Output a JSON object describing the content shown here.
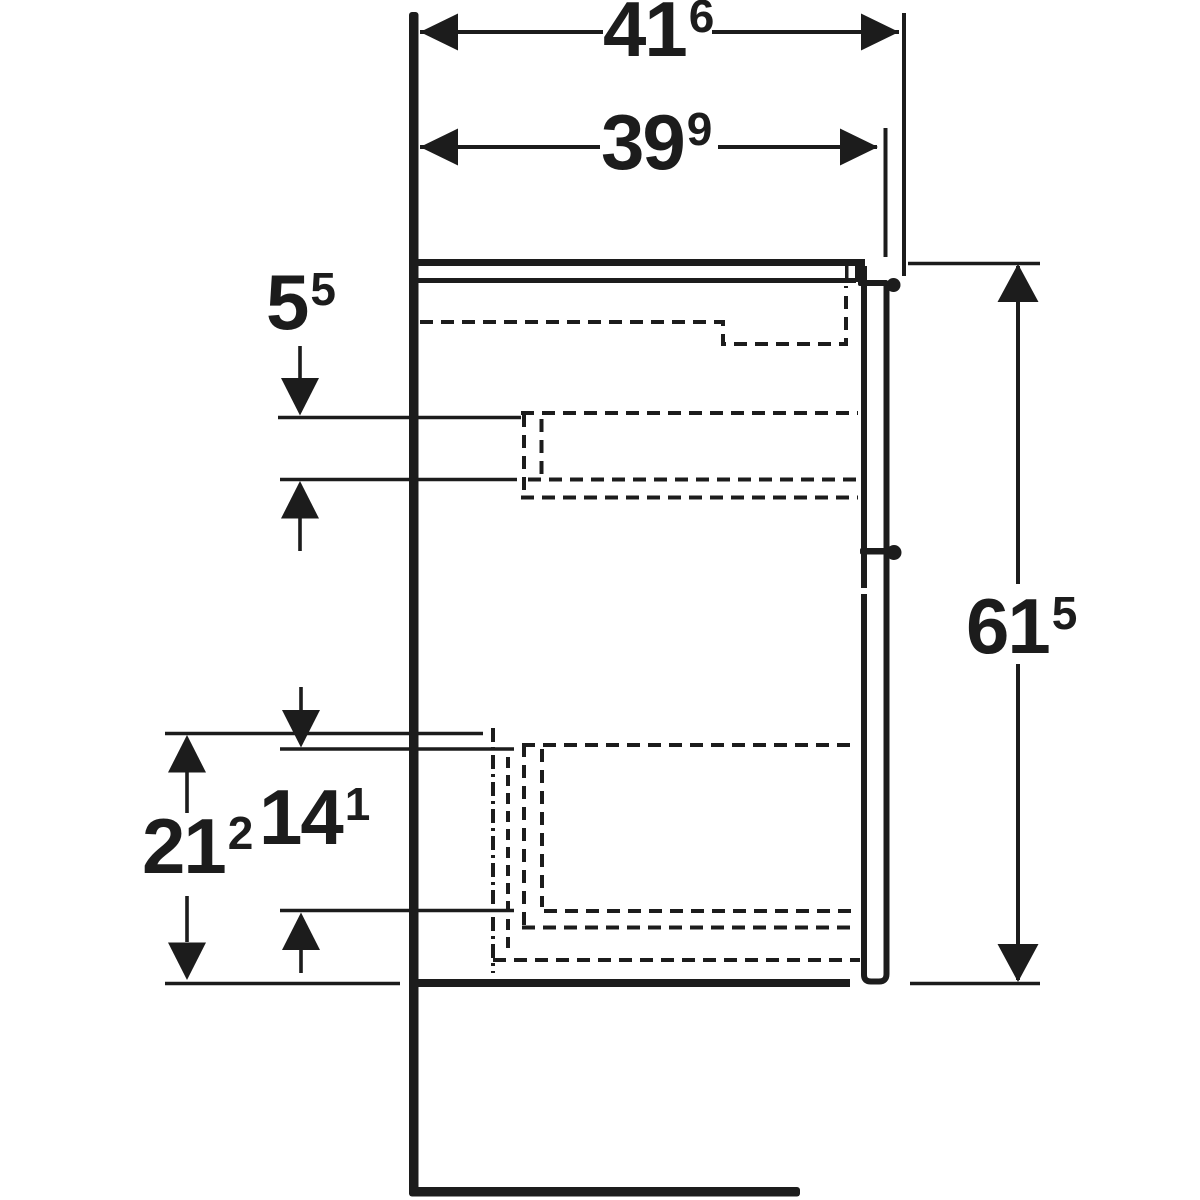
{
  "diagram": {
    "colors": {
      "line": "#1c1c1c",
      "background": "#ffffff"
    },
    "dimensions": {
      "width_total": {
        "main": "41",
        "sup": "6"
      },
      "width_cabinet": {
        "main": "39",
        "sup": "9"
      },
      "height_total": {
        "main": "61",
        "sup": "5"
      },
      "front_top_gap": {
        "main": "5",
        "sup": "5"
      },
      "bottom_section": {
        "main": "21",
        "sup": "2"
      },
      "bottom_drawer_inner": {
        "main": "14",
        "sup": "1"
      }
    }
  }
}
